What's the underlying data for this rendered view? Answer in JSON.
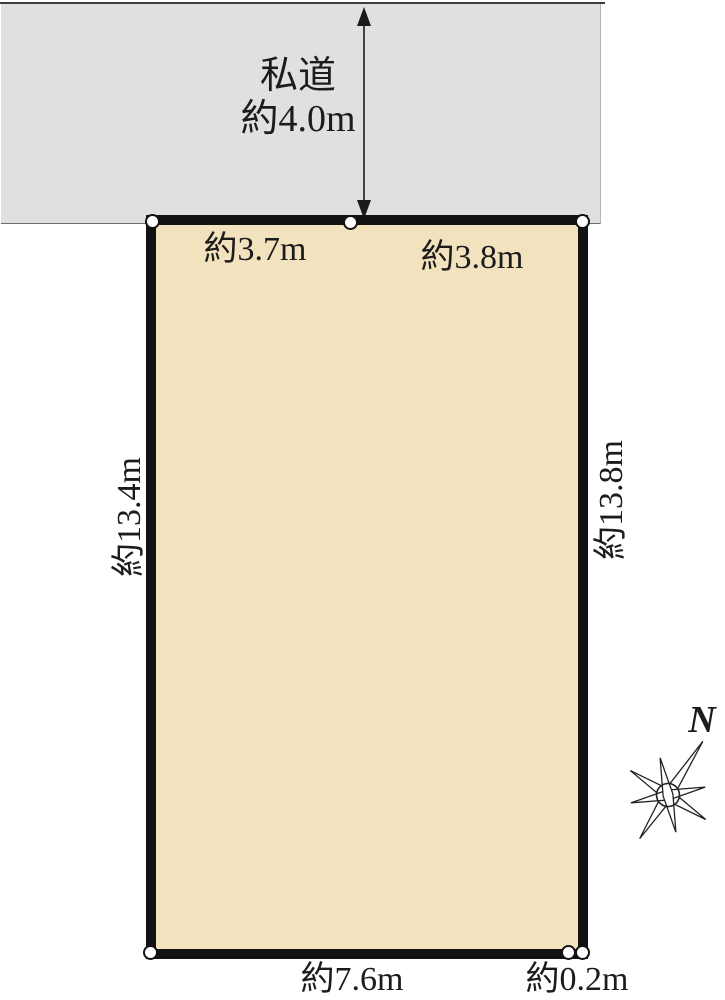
{
  "colors": {
    "background": "#ffffff",
    "road_fill": "#e0e0e0",
    "plot_fill": "#f2e2bd",
    "plot_border": "#121212"
  },
  "road": {
    "name": "私道",
    "width_label": "約4.0m"
  },
  "plot_dimensions": {
    "top_left_segment": "約3.7m",
    "top_right_segment": "約3.8m",
    "left_side": "約13.4m",
    "right_side": "約13.8m",
    "bottom_side": "約7.6m",
    "bottom_right_segment": "約0.2m"
  },
  "compass": {
    "north_label": "N"
  }
}
